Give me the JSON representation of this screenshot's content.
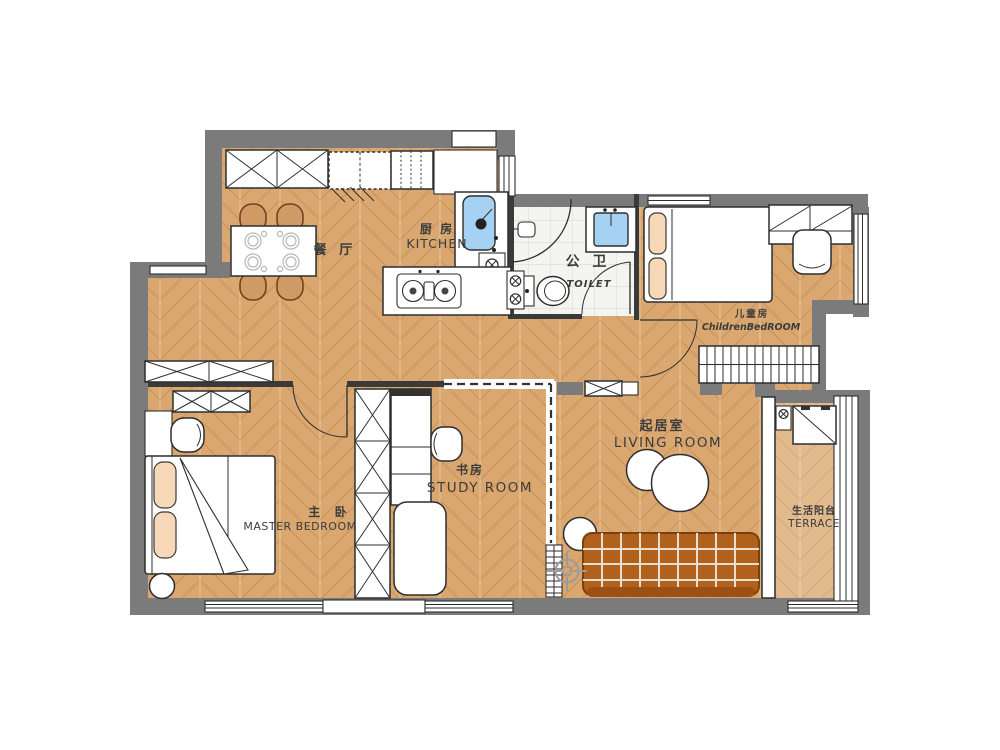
{
  "plan_type": "apartment-floor-plan",
  "rooms": {
    "dining": {
      "cn": "餐 厅",
      "en": ""
    },
    "kitchen": {
      "cn": "厨 房",
      "en": "KITCHEN"
    },
    "toilet": {
      "cn": "公 卫",
      "en": "TOILET"
    },
    "children": {
      "cn": "儿童房",
      "en": "ChildrenBedROOM"
    },
    "master": {
      "cn": "主 卧",
      "en": "MASTER BEDROOM"
    },
    "study": {
      "cn": "书房",
      "en": "STUDY ROOM"
    },
    "living": {
      "cn": "起居室",
      "en": "LIVING ROOM"
    },
    "terrace": {
      "cn": "生活阳台",
      "en": "TERRACE"
    }
  },
  "colors": {
    "wall": "#7b7b7b",
    "wood_floor": "#d9a76f",
    "wood_grain": "#c68e54",
    "terrace_tint": "#e3b888",
    "tile_floor": "#f4f4f1",
    "sink_blue": "#a5d2f3",
    "sofa_brown": "#b2611c",
    "chair_tan": "#cf9a66",
    "pillow_peach": "#f7d9b9",
    "outline": "#2e2e2e",
    "label_text": "#3c3c3c"
  },
  "icons": {
    "compass": "crosshair-compass-icon",
    "drain": "circled-x-drain-icon",
    "door": "quarter-arc-door-swing",
    "window": "triple-line-window"
  }
}
